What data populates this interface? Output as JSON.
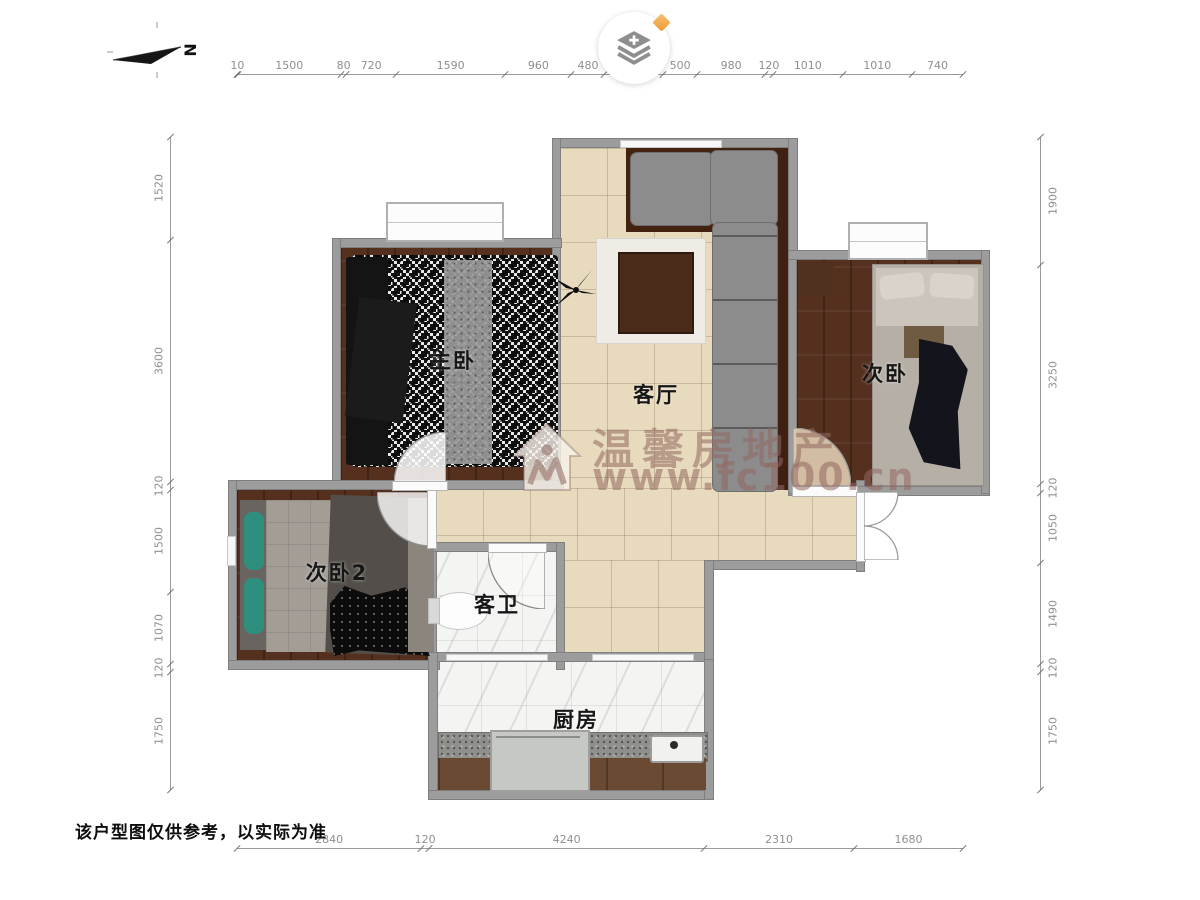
{
  "header": {
    "compass_label": "N",
    "map_tool_button": {
      "icon": "layers-plus-icon",
      "badge_icon": "gem-diamond-icon"
    }
  },
  "watermark": {
    "brand": "温馨房地产",
    "site": "www.fc100.cn"
  },
  "rooms": {
    "master_bedroom": "主卧",
    "living_room": "客厅",
    "bedroom2": "次卧",
    "bedroom3": "次卧2",
    "guest_bathroom": "客卫",
    "kitchen": "厨房"
  },
  "disclaimer": "该户型图仅供参考，以实际为准",
  "dimensions_mm": {
    "top": [
      10,
      1500,
      80,
      720,
      1590,
      960,
      480,
      850,
      500,
      980,
      120,
      1010,
      1010,
      740
    ],
    "bottom": [
      2840,
      120,
      4240,
      2310,
      1680
    ],
    "left": [
      1520,
      3600,
      120,
      1500,
      1070,
      120,
      1750
    ],
    "right": [
      1900,
      3250,
      120,
      1050,
      1490,
      120,
      1750
    ]
  },
  "colors": {
    "wall": "#9c9c9c",
    "wood_floor": "#55301f",
    "tile_floor": "#e8dabd",
    "marble_floor": "#f4f4f2",
    "sofa": "#8c8c8c",
    "accent_orange": "#f2a64e",
    "dimension_text": "#8f8f8f",
    "watermark": "rgba(146,104,96,0.55)"
  }
}
